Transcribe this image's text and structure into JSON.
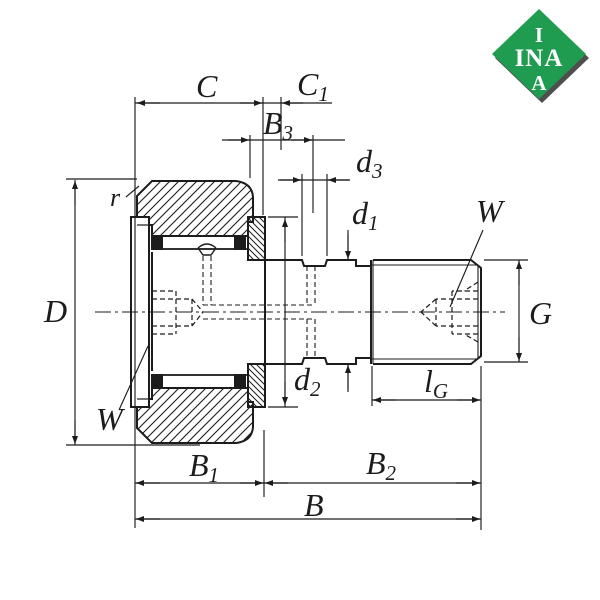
{
  "drawing": {
    "background": "#ffffff",
    "line_color": "#1c1c1c",
    "type_note": "stud type track roller cam follower cross-section"
  },
  "logo": {
    "brand": "INA",
    "green": "#1f9c4f",
    "shadow": "#4f4f4f",
    "line1": "I",
    "line2": "INA",
    "line3": "A"
  },
  "dimensions": {
    "C": {
      "main": "C",
      "sub": ""
    },
    "C1": {
      "main": "C",
      "sub": "1"
    },
    "B3": {
      "main": "B",
      "sub": "3"
    },
    "d3": {
      "main": "d",
      "sub": "3"
    },
    "d1": {
      "main": "d",
      "sub": "1"
    },
    "d2": {
      "main": "d",
      "sub": "2"
    },
    "D": {
      "main": "D",
      "sub": ""
    },
    "r": {
      "main": "r",
      "sub": ""
    },
    "W_left": {
      "main": "W",
      "sub": ""
    },
    "W_right": {
      "main": "W",
      "sub": ""
    },
    "G": {
      "main": "G",
      "sub": ""
    },
    "lG": {
      "main": "l",
      "sub": "G"
    },
    "B1": {
      "main": "B",
      "sub": "1"
    },
    "B2": {
      "main": "B",
      "sub": "2"
    },
    "B": {
      "main": "B",
      "sub": ""
    }
  }
}
